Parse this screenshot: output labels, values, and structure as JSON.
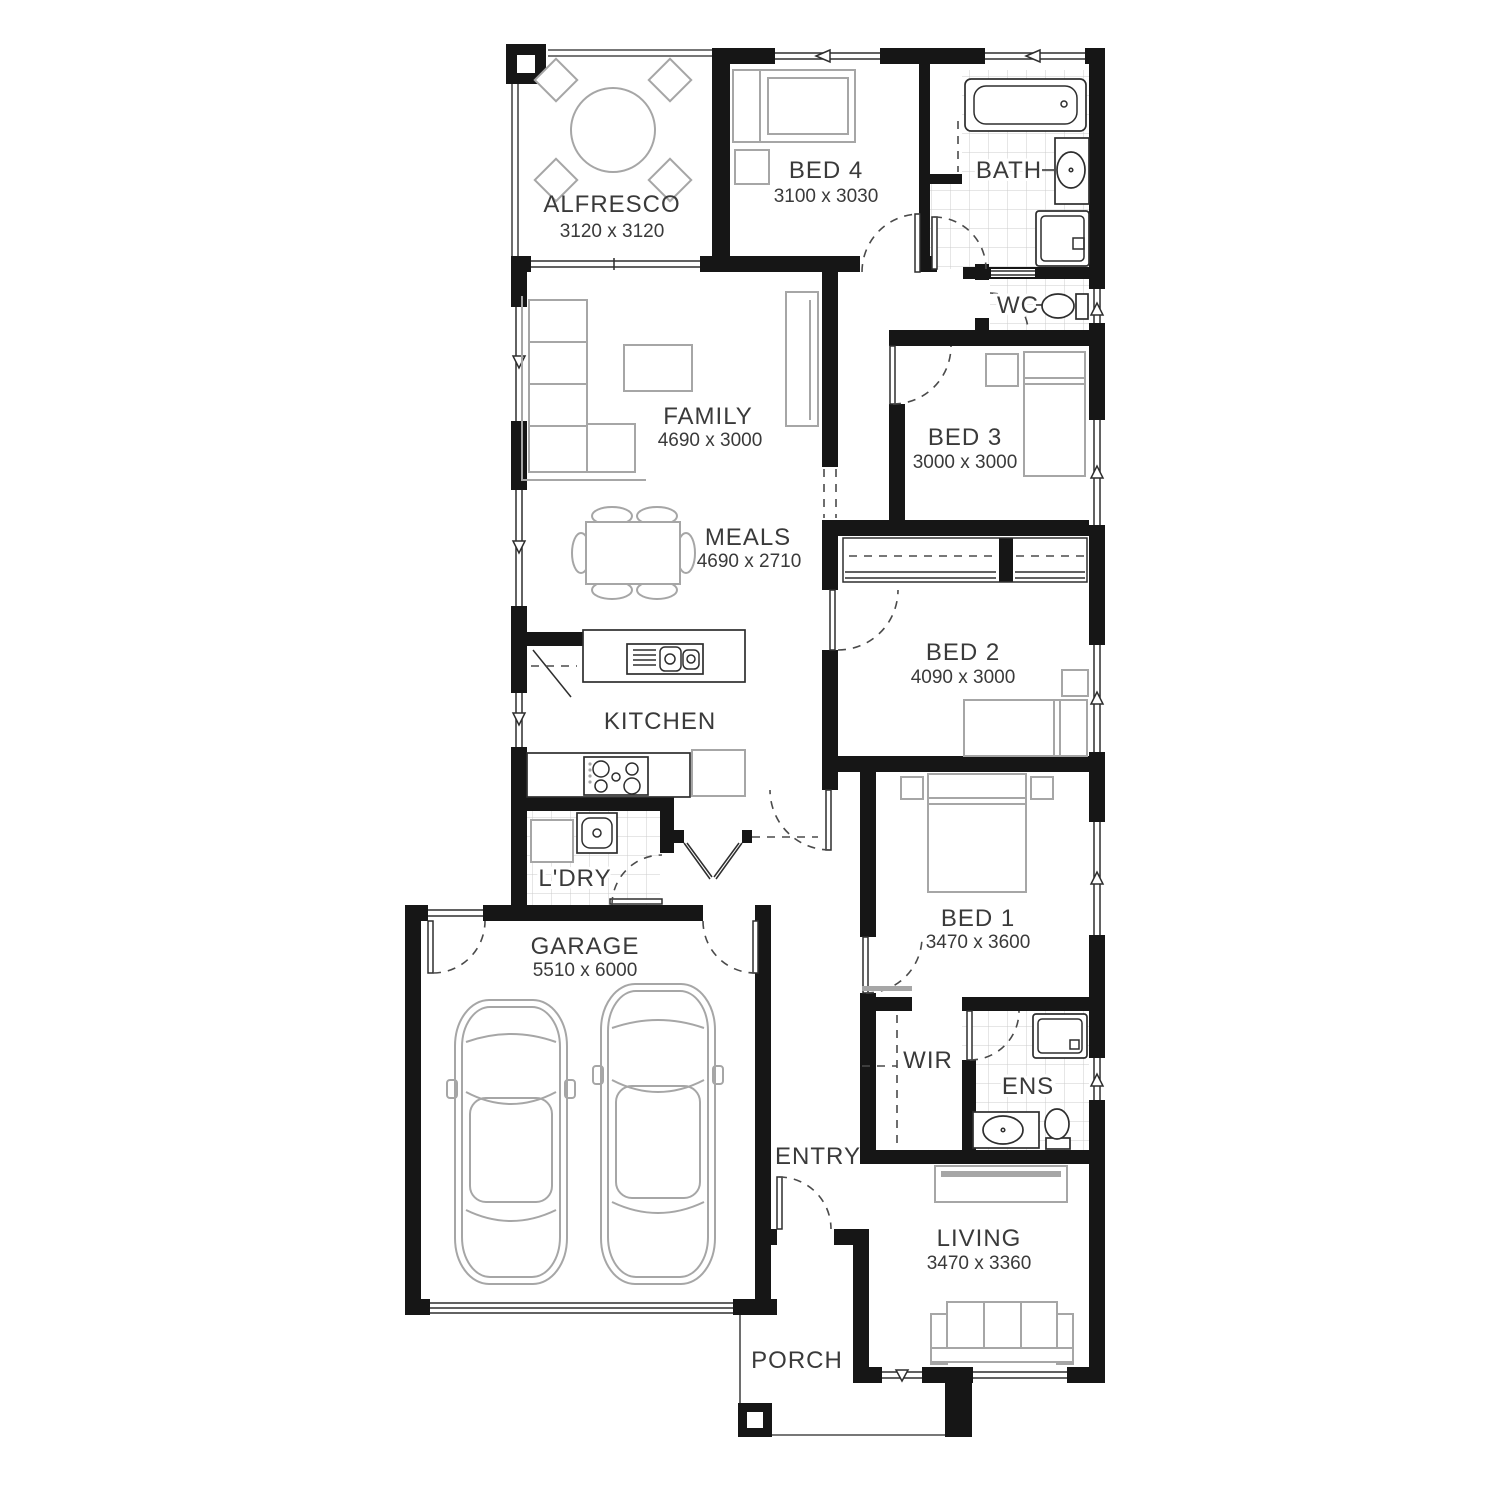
{
  "plan": {
    "colors": {
      "background": "#ffffff",
      "wall": "#161616",
      "furniture_gray": "#a6a6a6",
      "fixture_line": "#2e2e2e",
      "tile_line": "#cccccc",
      "label": "#3a3a3a"
    },
    "rooms": {
      "alfresco": {
        "label": "ALFRESCO",
        "dims": "3120 x 3120"
      },
      "bed4": {
        "label": "BED 4",
        "dims": "3100 x 3030"
      },
      "bath": {
        "label": "BATH"
      },
      "wc": {
        "label": "WC"
      },
      "family": {
        "label": "FAMILY",
        "dims": "4690 x 3000"
      },
      "meals": {
        "label": "MEALS",
        "dims": "4690 x 2710"
      },
      "bed3": {
        "label": "BED 3",
        "dims": "3000 x 3000"
      },
      "bed2": {
        "label": "BED 2",
        "dims": "4090 x 3000"
      },
      "kitchen": {
        "label": "KITCHEN"
      },
      "ldry": {
        "label": "L'DRY"
      },
      "garage": {
        "label": "GARAGE",
        "dims": "5510 x 6000"
      },
      "bed1": {
        "label": "BED 1",
        "dims": "3470 x 3600"
      },
      "wir": {
        "label": "WIR"
      },
      "ens": {
        "label": "ENS"
      },
      "entry": {
        "label": "ENTRY"
      },
      "living": {
        "label": "LIVING",
        "dims": "3470 x 3360"
      },
      "porch": {
        "label": "PORCH"
      }
    }
  }
}
